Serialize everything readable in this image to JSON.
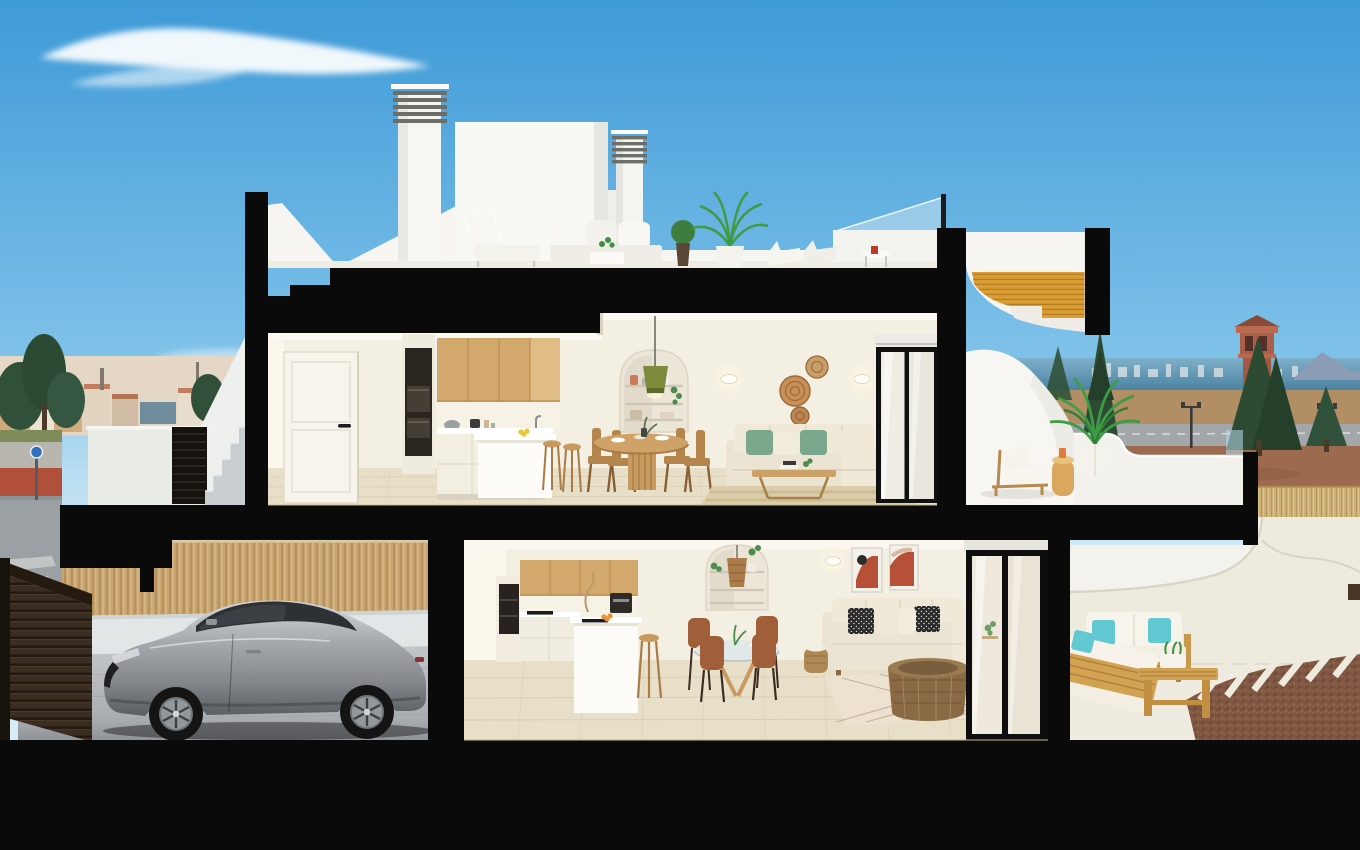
{
  "meta": {
    "title": "Two-storey coastal villa cutaway 3D render",
    "width": 1360,
    "height": 850,
    "no_visible_text": true
  },
  "palette": {
    "black": "#0a0a0a",
    "skyTop": "#3e9ad7",
    "skyMid": "#7fc2e9",
    "skyLow": "#d6ecf7",
    "whiteExt": "#f6f5f1",
    "shadeExt": "#e4e4df",
    "wallWarm": "#f4efe3",
    "wallLit": "#fbf7ec",
    "floorTile": "#e8dfc9",
    "wood": "#d2a86c",
    "woodDark": "#b08048",
    "goldStair": "#d99d33",
    "cream": "#ece4d2",
    "pillowGreen": "#7ba78c",
    "pillowTeal": "#62c8d2",
    "carSilver": "#a7abb0",
    "fenceTan": "#c7a36f",
    "driveGray": "#b6b9bc",
    "seaBlue": "#4d84a6",
    "fieldTan": "#b18e63",
    "dirtRed": "#9c6a4e",
    "treeGreen": "#2f4d36",
    "towerTerra": "#aa5f49",
    "gravelBrown": "#7f5742",
    "terraceWhite": "#efe9dd",
    "doorDark": "#34291e"
  },
  "labels": {
    "scene": "photoreal cutaway section of a two-storey villa against blue sky",
    "sky": "blue sky with wispy clouds",
    "town": "distant coastal town with terracotta roofs and trees",
    "street": "street with red bike lane and sidewalk",
    "sea": "sea horizon with distant skyline and mountain",
    "tower": "terracotta watchtower",
    "field": "dry field, road with lampposts and reed fence",
    "building": "two-storey villa cut open showing interiors",
    "roof": "roof terrace with chimneys, stair bulkhead and lounge set",
    "chimney": "white louvered chimney",
    "roof_lounge": "white outdoor lounge set with plants and sun loungers",
    "glass_rail": "glass roof balustrade",
    "roof_stair": "golden timber stair under curved soffit",
    "upper_floor": "upper floor apartment",
    "entry_door": "white panelled entry door",
    "upper_kitchen": "oak and white kitchen with island and stools",
    "upper_dining": "round timber dining table with chairs",
    "niche": "arched shelving niche",
    "pendant": "olive pendant lamp",
    "baskets": "woven wall baskets",
    "upper_living": "cream sofa with green cushions, coffee table and rug",
    "sliding_door": "black framed sliding glass door",
    "upper_terrace": "upper terrace with sun lounger, side table and potted palm",
    "entry_stairs": "exterior concrete entry stairs with gate",
    "garage": "driveway with timber fence",
    "car": "silver sports coupe",
    "lower_floor": "ground floor apartment",
    "lower_kitchen": "ground floor kitchen with island and stool",
    "lower_dining": "glass dining table with brown chairs",
    "lower_living": "sofa with patterned cushions, art frames and rattan table",
    "lower_terrace": "terrace with wooden garden set, pavers and gravel",
    "cut": "black sectioned walls and slabs",
    "ground": "sectioned ground plane"
  },
  "inventory": {
    "roof": [
      "chimney-left",
      "chimney-right",
      "stair-bulkhead",
      "lounge-chair",
      "outdoor-sofa",
      "plant-pot",
      "potted-palm",
      "sun-loungers",
      "side-table-red-cup",
      "glass-balustrade",
      "gold-stair"
    ],
    "upper_floor": [
      "entry-door",
      "oven-column",
      "oak-upper-cabinets",
      "white-base-cabinets",
      "kitchen-island",
      "bar-stools",
      "dining-table",
      "dining-chairs",
      "arched-niche",
      "pendant-lamp",
      "wall-sconces",
      "wall-baskets",
      "sofa",
      "coffee-table",
      "rug",
      "sliding-door"
    ],
    "upper_terrace": [
      "curved-white-wall",
      "parapet",
      "sun-lounger",
      "side-table",
      "potted-palm",
      "glass-panel"
    ],
    "garage": [
      "timber-fence",
      "white-wall",
      "paved-driveway",
      "garage-door",
      "sports-car"
    ],
    "lower_floor": [
      "oven-column",
      "oak-upper-cabinets",
      "cooktop",
      "coffee-machine",
      "island-with-sink",
      "stool",
      "arched-niche",
      "rattan-pendant",
      "glass-dining-table",
      "four-chairs",
      "wall-lamp",
      "two-art-frames",
      "sofa",
      "blanket-basket",
      "diamond-rug",
      "rattan-coffee-table",
      "sliding-door"
    ],
    "lower_terrace": [
      "white-parapet-ramp",
      "wood-sofa",
      "wood-lounge-sofa",
      "wood-bench-table",
      "planter",
      "paver-strips",
      "gravel-bed"
    ]
  }
}
